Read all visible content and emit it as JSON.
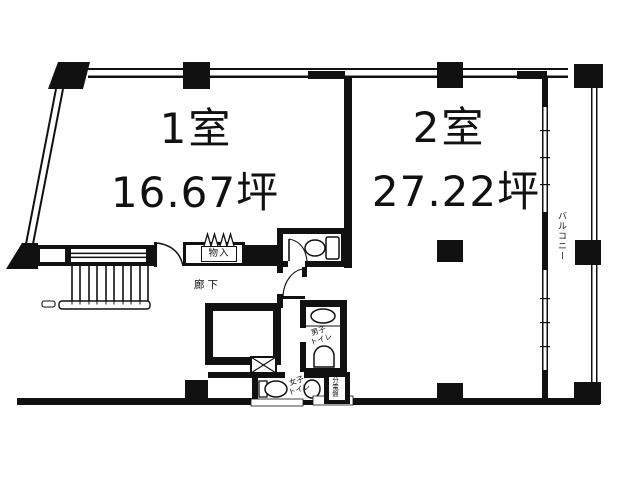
{
  "colors": {
    "ink": "#111111",
    "paper": "#ffffff"
  },
  "plan": {
    "rooms": [
      {
        "name": "1室",
        "area": "16.67坪"
      },
      {
        "name": "2室",
        "area": "27.22坪"
      }
    ],
    "labels": {
      "storage": "物入",
      "corridor": "廊下",
      "mens_toilet": "男子\nトイレ",
      "womens_toilet": "女子\nトイレ",
      "electrical_panel": "分電盤",
      "balcony": "バルコニー"
    }
  }
}
